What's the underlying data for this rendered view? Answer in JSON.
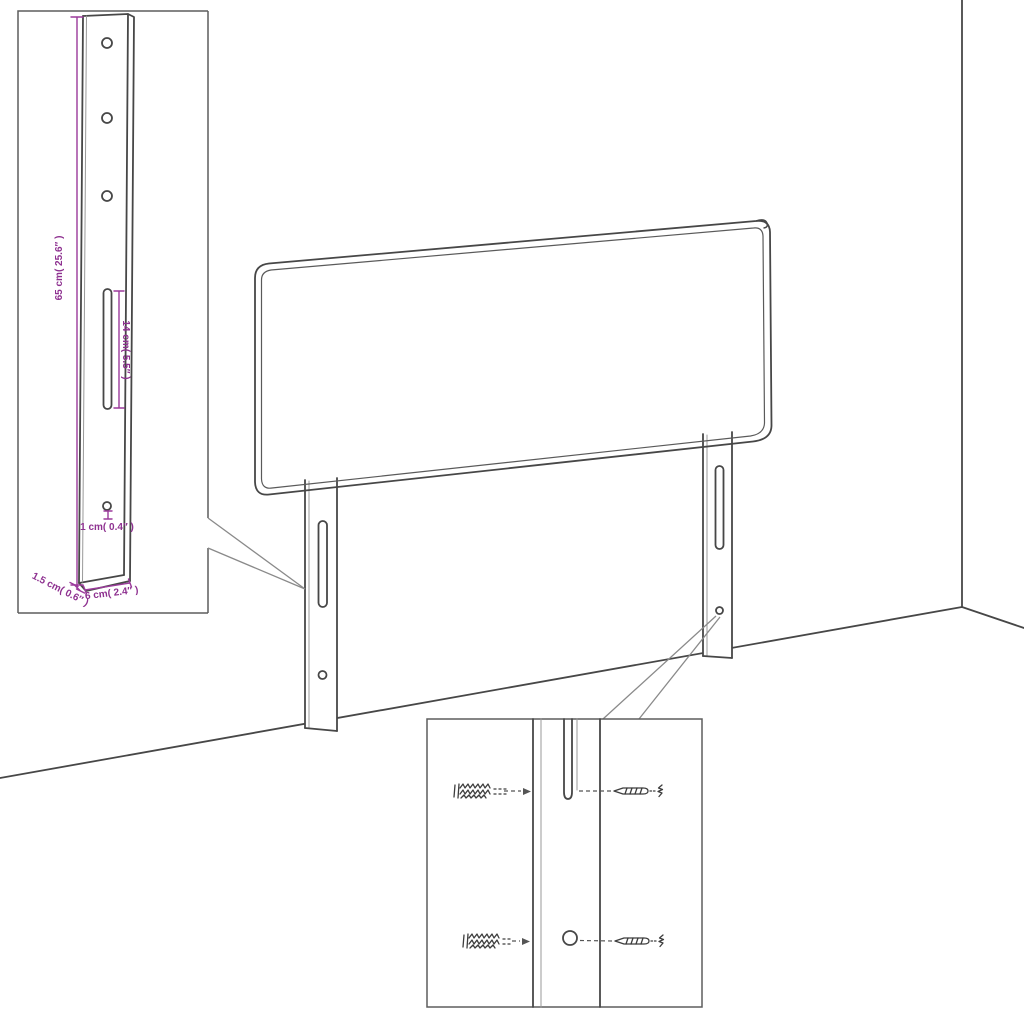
{
  "diagram": {
    "title_hint": "headboard with mounting-bracket dimension callouts",
    "colors": {
      "outline": "#474747",
      "dimension_purple": "#8e3190",
      "light_line": "#999999",
      "inset_border": "#5d5d5d",
      "background": "#ffffff"
    },
    "labels": {
      "bracket_height": "65 cm( 25.6″ )",
      "slot_length": "14 cm( 5.5″ )",
      "hole_diameter": "1 cm( 0.4″ )",
      "bracket_thickness": "1.5 cm( 0.6″ )",
      "bracket_width": "6 cm( 2.4″ )"
    },
    "dimensions": [
      {
        "name": "bracket height",
        "cm": 65,
        "inch": 25.6
      },
      {
        "name": "slot length",
        "cm": 14,
        "inch": 5.5
      },
      {
        "name": "hole diameter",
        "cm": 1,
        "inch": 0.4
      },
      {
        "name": "bracket thickness",
        "cm": 1.5,
        "inch": 0.6
      },
      {
        "name": "bracket width",
        "cm": 6,
        "inch": 2.4
      }
    ]
  }
}
